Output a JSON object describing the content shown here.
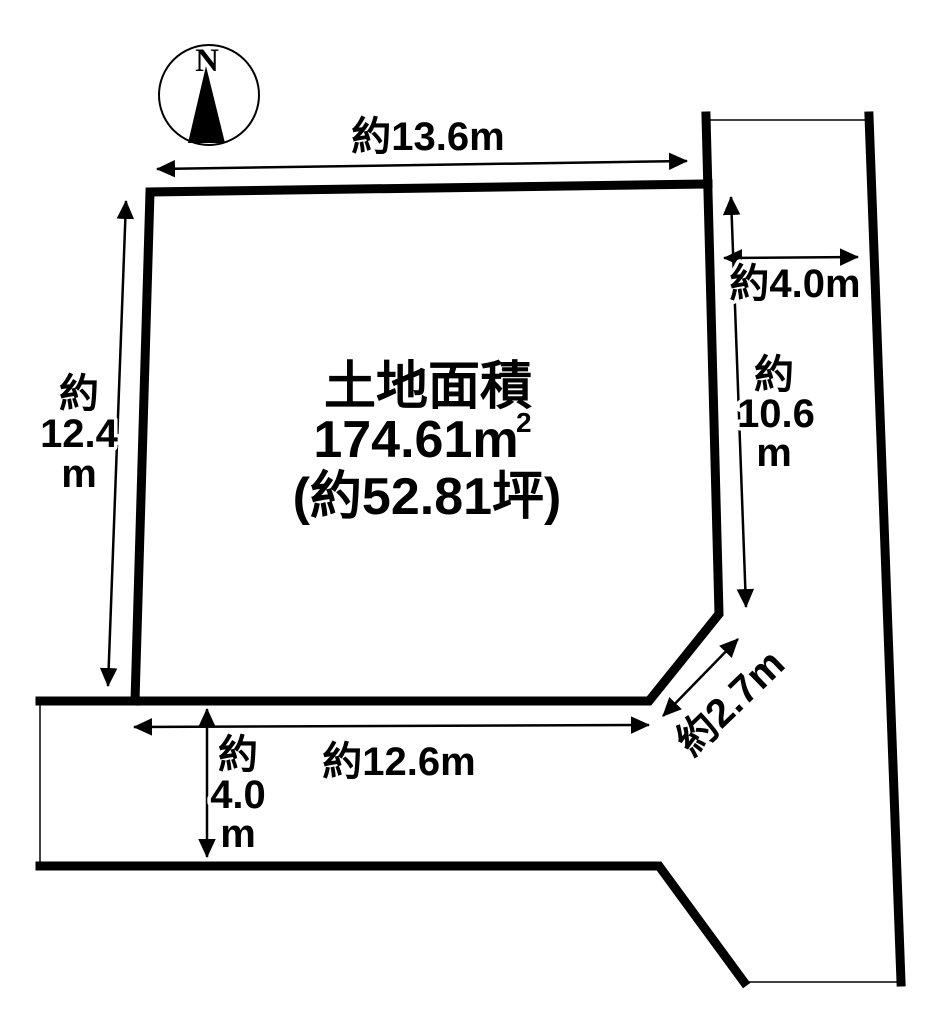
{
  "diagram": {
    "compass": {
      "north_label": "N"
    },
    "area": {
      "title": "土地面積",
      "value": "174.61m",
      "value_sup": "2",
      "tsubo": "(約52.81坪)"
    },
    "dimensions": {
      "top_width": "約13.6m",
      "west_depth": [
        "約",
        "12.4",
        "m"
      ],
      "east_road_width": "約4.0m",
      "east_depth": [
        "約",
        "10.6",
        "m"
      ],
      "southeast_corner": "約2.7m",
      "south_width": "約12.6m",
      "south_road_width": [
        "約",
        "4.0",
        "m"
      ]
    },
    "colors": {
      "line": "#000000",
      "background": "#ffffff"
    }
  }
}
